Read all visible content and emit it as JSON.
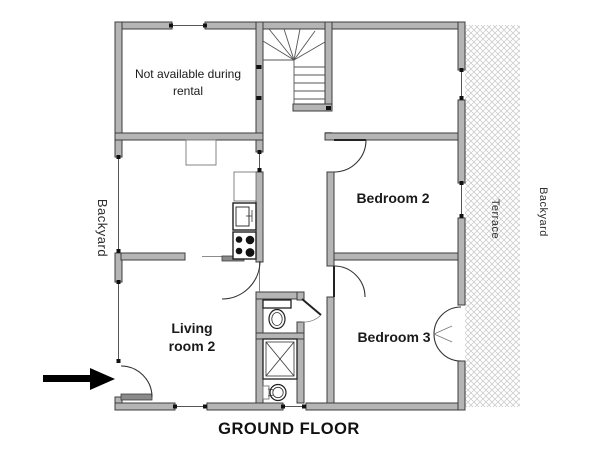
{
  "title": "GROUND FLOOR",
  "labels": {
    "not_available_line1": "Not available during",
    "not_available_line2": "rental",
    "bedroom2": "Bedroom 2",
    "bedroom3": "Bedroom 3",
    "living_line1": "Living",
    "living_line2": "room 2",
    "backyard_left": "Backyard",
    "terrace": "Terrace",
    "backyard_right": "Backyard"
  },
  "colors": {
    "wall_fill": "#b5b5b5",
    "wall_stroke": "#3d3d3d",
    "hatch_line": "#c6c6c6",
    "text": "#1a1a1a",
    "arrow": "#000000"
  }
}
